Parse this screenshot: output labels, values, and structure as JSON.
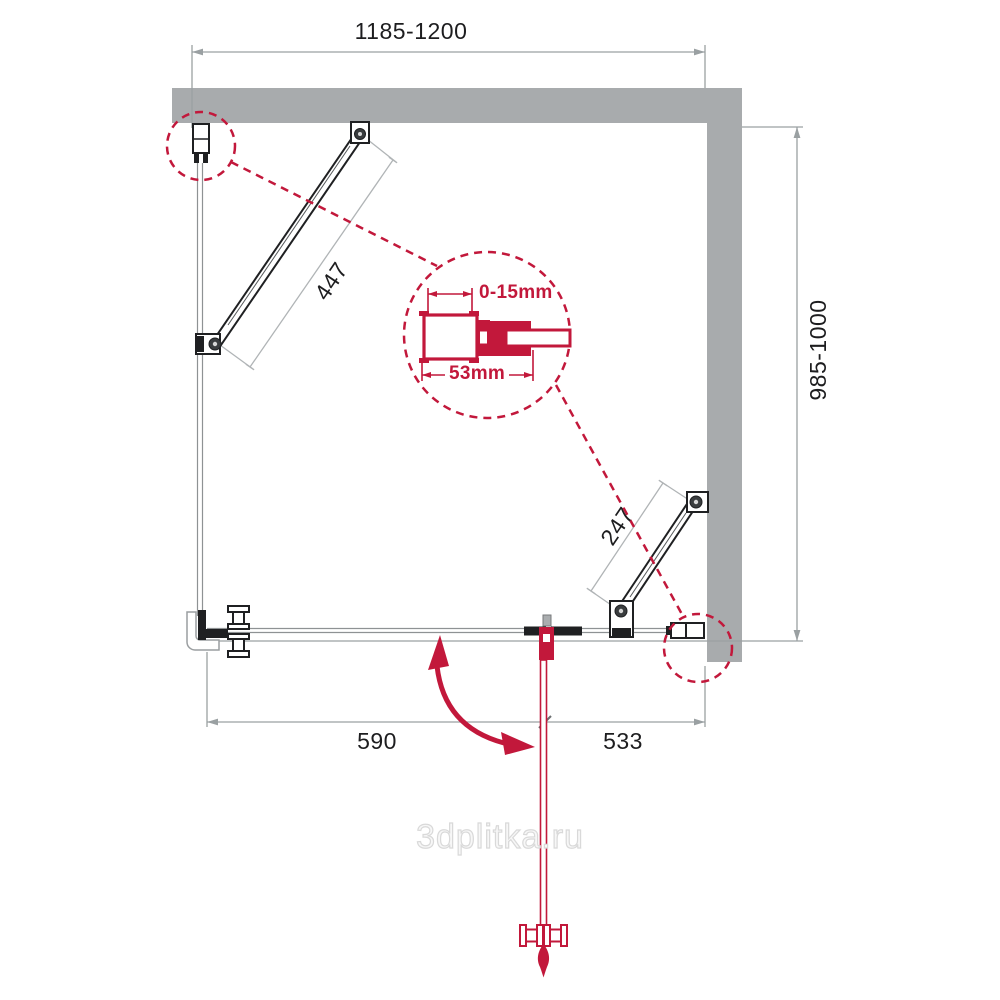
{
  "drawing": "shower-enclosure-plan",
  "dimensions": {
    "top_width": "1185-1200",
    "side_depth": "985-1000",
    "brace_left_length": "447",
    "brace_right_length": "247",
    "door_segment_width": "590",
    "fixed_segment_width": "533"
  },
  "detail_inset": {
    "adjustment_range": "0-15mm",
    "profile_width": "53mm"
  },
  "watermark": "3dplitka.ru",
  "colors": {
    "wall_gray": "#a8abad",
    "accent_red": "#c2183b",
    "dimension_gray": "#9aa0a2",
    "linework_black": "#1f2022"
  }
}
